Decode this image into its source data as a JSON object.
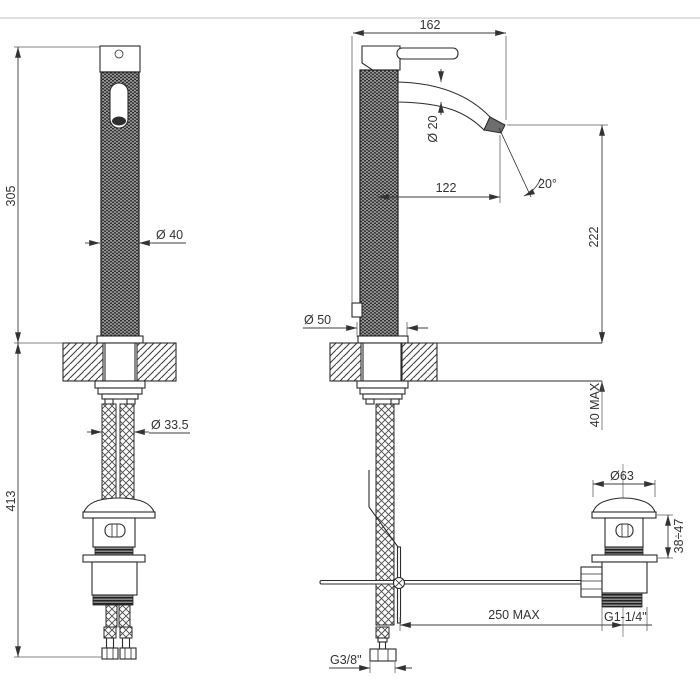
{
  "meta": {
    "type": "technical dimensional drawing",
    "subject": "single-lever basin mixer with knurled body and pop-up waste"
  },
  "labels": {
    "front": {
      "height_above_deck": "305",
      "length_below_deck": "413",
      "body_diameter": "Ø 40",
      "hole_diameter": "Ø 33.5"
    },
    "side": {
      "overall_depth": "162",
      "spout_diameter": "Ø 20",
      "spout_reach": "122",
      "spout_angle": "20°",
      "spout_height": "222",
      "base_diameter": "Ø 50",
      "deck_thickness": "40 MAX",
      "rod_reach": "250 MAX"
    },
    "waste": {
      "cap_diameter": "Ø63",
      "height_range": "38÷47",
      "drain_thread": "G1-1/4\"",
      "supply_thread": "G3/8\""
    }
  }
}
